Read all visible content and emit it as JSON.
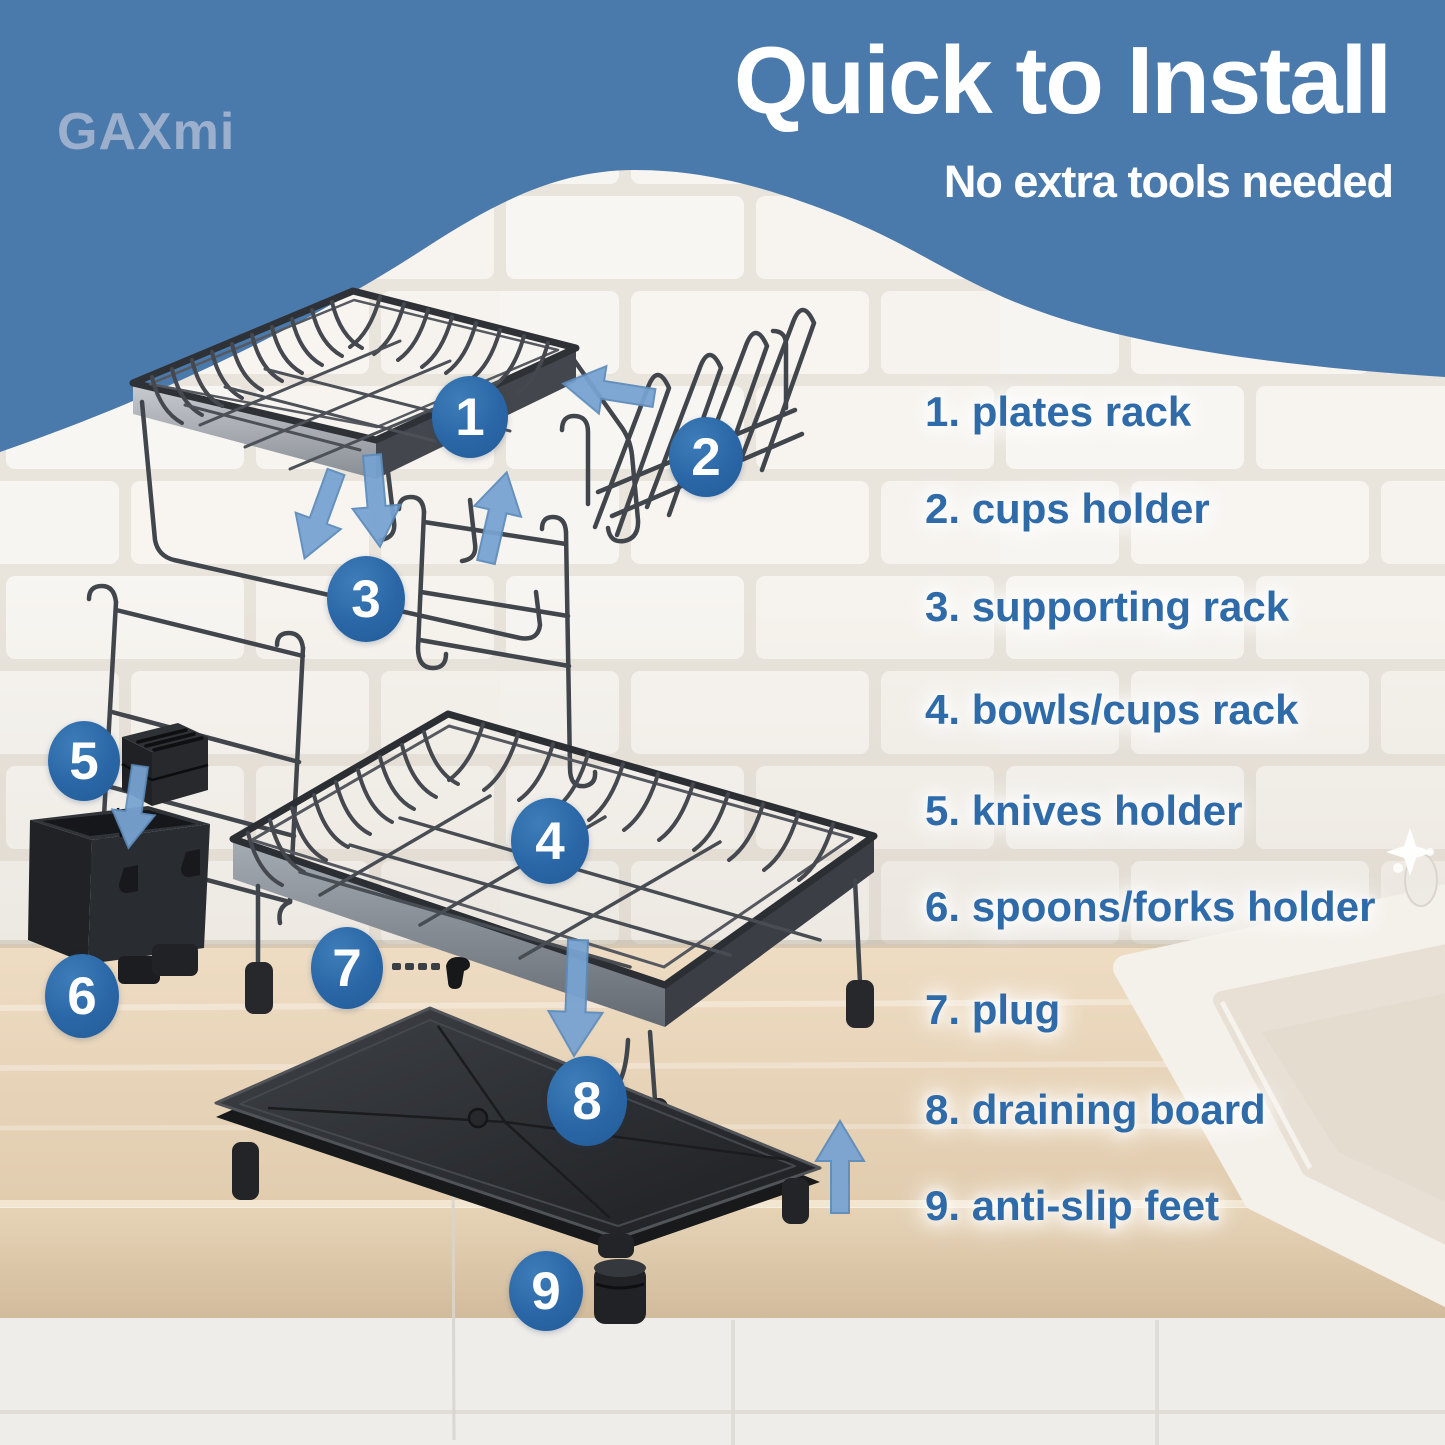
{
  "brand": {
    "name": "GAXmi"
  },
  "header": {
    "title": "Quick to Install",
    "subtitle": "No extra tools needed"
  },
  "parts": {
    "items": [
      {
        "num": "1",
        "name": "plates rack",
        "label": "1. plates rack"
      },
      {
        "num": "2",
        "name": "cups holder",
        "label": "2. cups holder"
      },
      {
        "num": "3",
        "name": "supporting rack",
        "label": "3. supporting rack"
      },
      {
        "num": "4",
        "name": "bowls/cups rack",
        "label": "4. bowls/cups rack"
      },
      {
        "num": "5",
        "name": "knives holder",
        "label": "5. knives holder"
      },
      {
        "num": "6",
        "name": "spoons/forks holder",
        "label": "6. spoons/forks holder"
      },
      {
        "num": "7",
        "name": "plug",
        "label": "7. plug"
      },
      {
        "num": "8",
        "name": "draining board",
        "label": "8. draining board"
      },
      {
        "num": "9",
        "name": "anti-slip feet",
        "label": "9. anti-slip feet"
      }
    ]
  },
  "icons": {
    "down_arrow": "down-arrow",
    "up_arrow": "up-arrow",
    "left_arrow": "left-arrow",
    "sparkle": "sparkle"
  },
  "colors": {
    "header_blue": "#4a79ab",
    "label_blue": "#2e6ba8",
    "badge_blue": "#2a66a6",
    "arrow_blue": "#78a3d1",
    "logo_blue": "#9cb0cd",
    "wire_gray": "#3f434a",
    "plastic_black": "#222427"
  }
}
